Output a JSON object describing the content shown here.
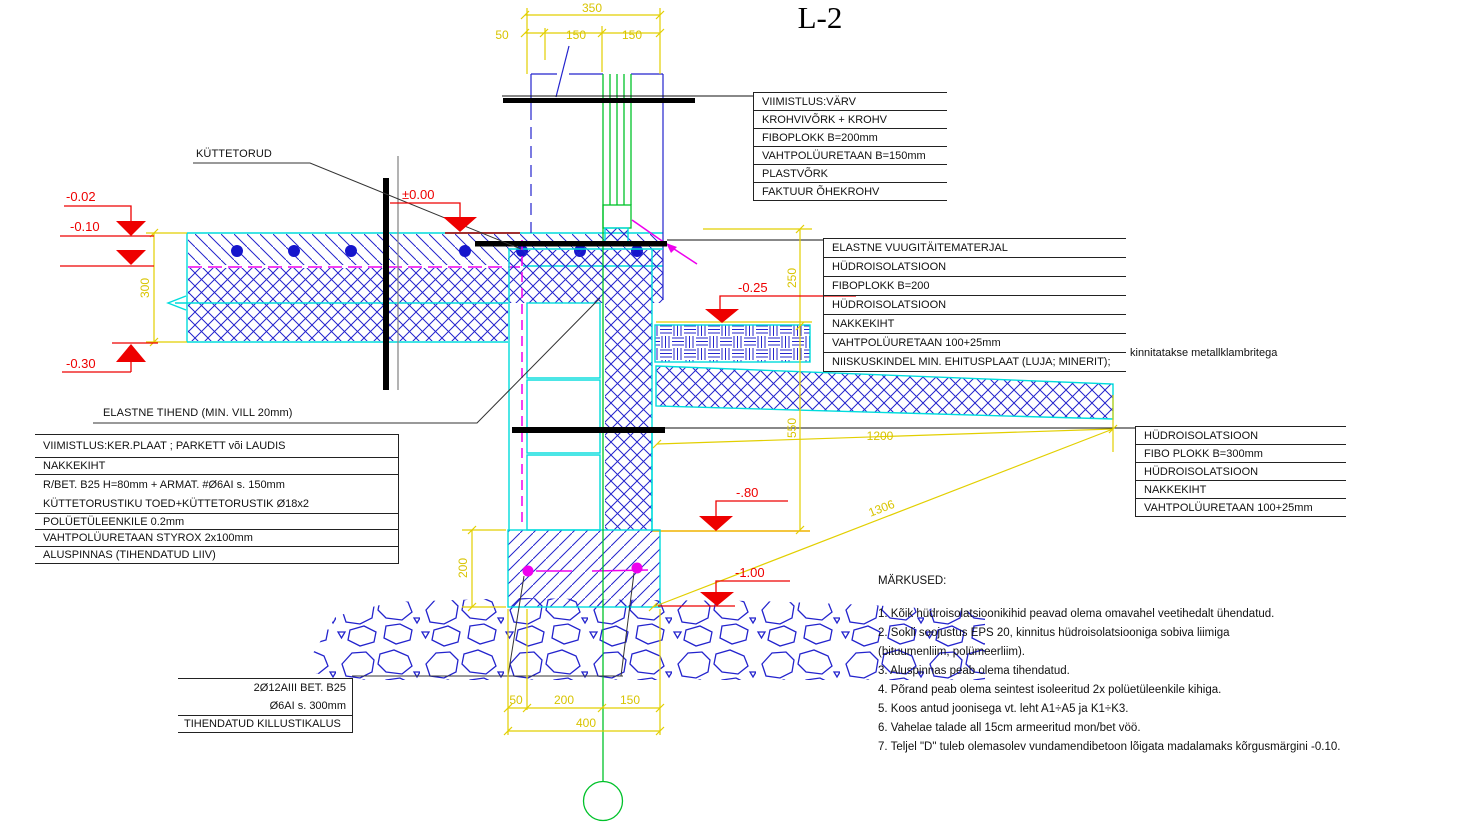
{
  "title": "L-2",
  "labels": {
    "kuttetorud": "KÜTTETORUD",
    "elastne_tihend": "ELASTNE TIHEND (MIN. VILL 20mm)"
  },
  "elevations": {
    "e002": "-0.02",
    "e010": "-0.10",
    "e030": "-0.30",
    "e000": "±0.00",
    "e025": "-0.25",
    "e080": "-.80",
    "e100": "-1.00"
  },
  "dims": {
    "d350": "350",
    "d50": "50",
    "d150a": "150",
    "d150b": "150",
    "d300": "300",
    "d250": "250",
    "d550": "550",
    "d200l": "200",
    "d200v": "200",
    "d1200": "1200",
    "d1306": "1306",
    "db50": "50",
    "db200": "200",
    "db150": "150",
    "db400": "400"
  },
  "blocks": {
    "top_right": {
      "rows": [
        "VIIMISTLUS:VÄRV",
        "KROHVIVÕRK + KROHV",
        "FIBOPLOKK B=200mm",
        "VAHTPOLÜURETAAN B=150mm",
        "PLASTVÕRK",
        "FAKTUUR ÕHEKROHV"
      ]
    },
    "mid_right": {
      "rows": [
        "ELASTNE VUUGITÄITEMATERJAL",
        "HÜDROISOLATSIOON",
        "FIBOPLOKK B=200",
        "HÜDROISOLATSIOON",
        "NAKKEKIHT",
        "VAHTPOLÜURETAAN 100+25mm",
        "NIISKUSKINDEL MIN. EHITUSPLAAT  (LUJA; MINERIT);"
      ],
      "suffix": "kinnitatakse metallklambritega"
    },
    "floor_left": {
      "rows": [
        "VIIMISTLUS:KER.PLAAT ; PARKETT või LAUDIS",
        "NAKKEKIHT",
        "R/BET. B25 H=80mm + ARMAT. #Ø6AI s. 150mm",
        "KÜTTETORUSTIKU TOED+KÜTTETORUSTIK Ø18x2",
        "POLÜETÜLEENKILE 0.2mm",
        "VAHTPOLÜURETAAN STYROX 2x100mm",
        "ALUSPINNAS (TIHENDATUD LIIV)"
      ]
    },
    "plinth_right": {
      "rows": [
        "HÜDROISOLATSIOON",
        "FIBO PLOKK B=300mm",
        "HÜDROISOLATSIOON",
        "NAKKEKIHT",
        "VAHTPOLÜURETAAN 100+25mm"
      ]
    },
    "footing_left": {
      "rows": [
        "2Ø12AIII  BET. B25",
        "Ø6AI s. 300mm",
        "TIHENDATUD KILLUSTIKALUS"
      ]
    }
  },
  "notes": {
    "heading": "MÄRKUSED:",
    "items": [
      "1. Kõik hüdroisolatsioonikihid peavad olema omavahel veetihedalt ühendatud.",
      "2. Sokli soojustus EPS 20, kinnitus hüdroisolatsiooniga sobiva liimiga\n    (bituumenliim, polümeerliim).",
      "3. Aluspinnas peab olema tihendatud.",
      "4. Põrand peab olema seintest isoleeritud 2x polüetüleenkile kihiga.",
      "5. Koos antud joonisega vt. leht A1÷A5 ja K1÷K3.",
      "6. Vahelae  talade all 15cm armeeritud mon/bet vöö.",
      "7. Teljel \"D\" tuleb olemasolev vundamendibetoon lõigata madalamaks kõrgusmärgini -0.10."
    ]
  },
  "colors": {
    "line_blue": "#2323cd",
    "cyan": "#00dcdc",
    "green": "#00c22a",
    "yellow": "#e2cf00",
    "red": "#ee0000",
    "magenta": "#ee00ee",
    "black": "#111111"
  }
}
